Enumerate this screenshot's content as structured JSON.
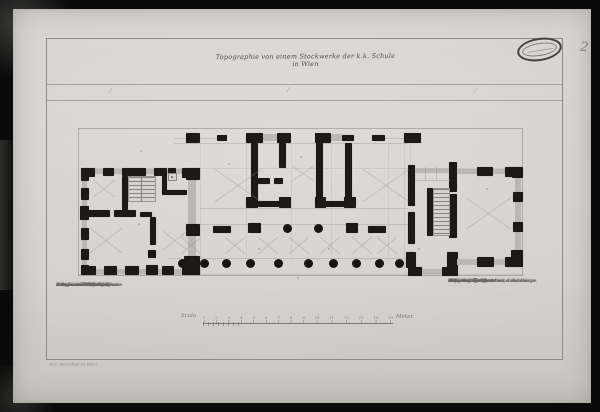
{
  "photo": {
    "border_color": "#0a0a0a",
    "paper_color": "#d4d2cd"
  },
  "sheet": {
    "page_number": "2",
    "axis_marks": [
      "⁄",
      "⁄",
      "⁄"
    ],
    "title_script": "Topographie von einem Stockwerke der k.k. Schule in Wien",
    "caption": "Gez. Marschall W. Wien"
  },
  "legend_left": {
    "header": "Zeichen.",
    "items": [
      {
        "no": "A.",
        "text": "Portal."
      },
      {
        "no": "1.",
        "text": "Vorraum mit den Gängen."
      },
      {
        "no": "2.",
        "text": "Stiege in das Gebäude."
      },
      {
        "no": "3.",
        "text": "Zimmer des Directors."
      },
      {
        "no": "4.",
        "text": "Schulzimmer der IV. Classe."
      },
      {
        "no": "5.",
        "text": "Schulzimmer der III. Classe."
      },
      {
        "no": "6.",
        "text": "Lehrzimmer der II. Classe."
      },
      {
        "no": "7.",
        "text": "Saal für die Prüfungen."
      },
      {
        "no": "8.",
        "text": "Stiege zum Hofe."
      },
      {
        "no": "9.",
        "text": "Gang mit den Säulen."
      }
    ]
  },
  "legend_right": {
    "header": "Zeichen.",
    "items": [
      {
        "no": "10.",
        "text": "Wohnung des Directors, 2 Zimmer."
      },
      {
        "no": "11.",
        "text": "Küche."
      },
      {
        "no": "12.",
        "text": "Gewölbe zum Vorrath."
      },
      {
        "no": "13.",
        "text": "Kleine Stiege."
      },
      {
        "no": "14.",
        "text": "Stiege im Gange."
      },
      {
        "no": "15.",
        "text": "Wirtschaftsgebäude mit dem inneren"
      },
      {
        "no": "",
        "text": "Hofe und Garten."
      },
      {
        "no": "16.",
        "text": "Abtritte im Erdgeschosse und Gänge."
      },
      {
        "no": "17.",
        "text": "Brunnen."
      }
    ]
  },
  "scale": {
    "label_left": "Scala",
    "label_right": "Meter.",
    "ticks": [
      "1",
      "2",
      "3",
      "4",
      "5",
      "6",
      "7",
      "8",
      "9",
      "10",
      "11",
      "12",
      "13",
      "14",
      "15"
    ]
  }
}
